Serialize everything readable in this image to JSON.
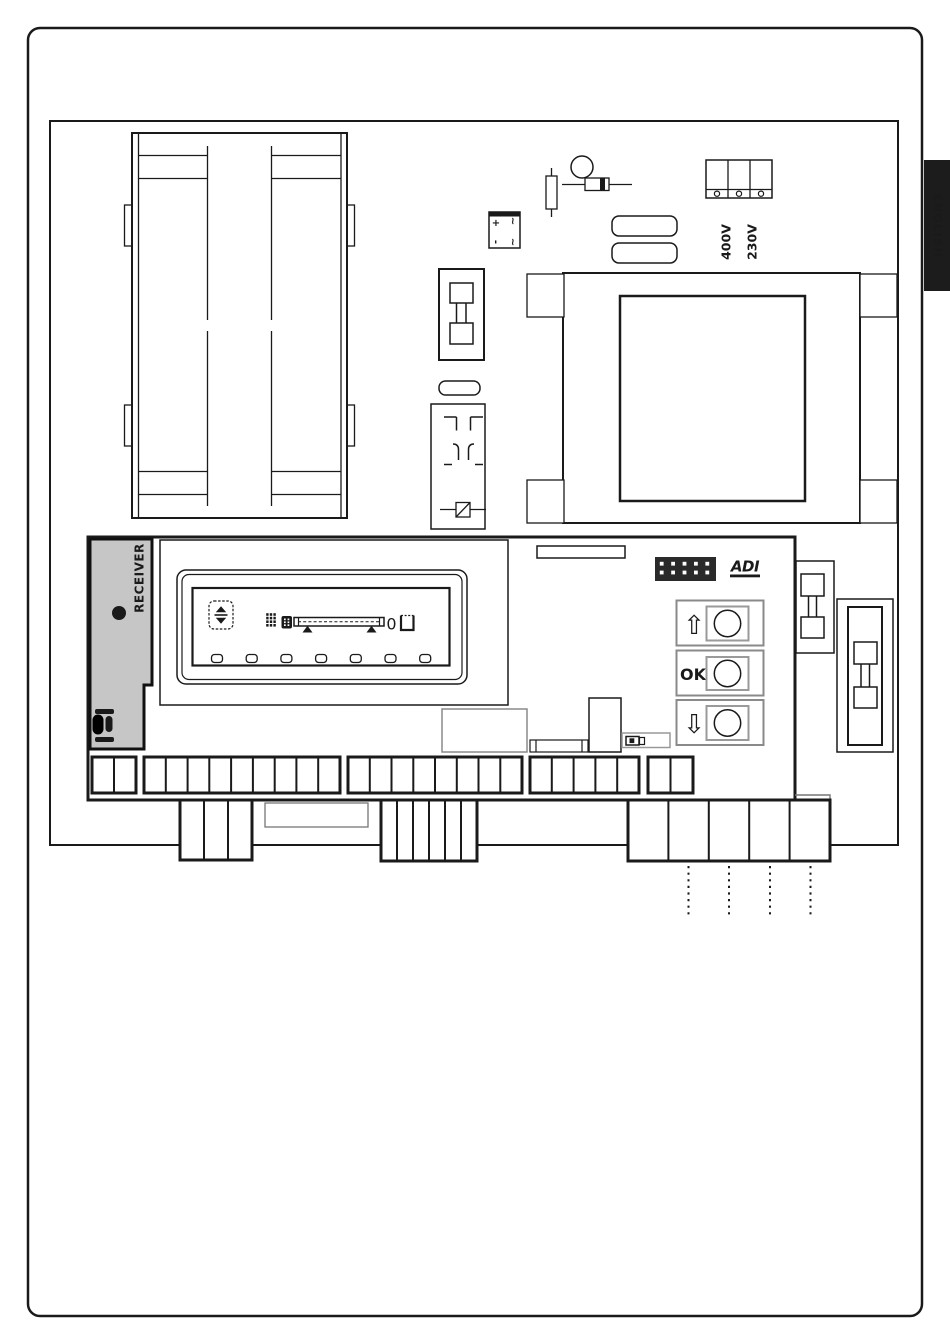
{
  "page": {
    "language_tab": "ENGLISH"
  },
  "colors": {
    "line": "#1a1a1a",
    "tab_bg": "#1c1c1c",
    "tab_text": "#ffffff",
    "receiver_fill": "#c6c6c6",
    "gray_border": "#8a8a8a"
  },
  "power_input": {
    "voltage_label_top": "400V",
    "voltage_label_bottom": "230V",
    "terminal_cells": 3
  },
  "rectifier": {
    "plus": "+",
    "ac_top": "~",
    "minus": "-",
    "ac_bottom": "~"
  },
  "control_board": {
    "receiver": {
      "label": "RECEIVER"
    },
    "logo_text": "ADI",
    "display": {
      "zero_indicator": "0",
      "led_count": 7
    },
    "buttons": {
      "up": "⇧",
      "ok": "OK",
      "down": "⇩"
    },
    "terminal_blocks": [
      {
        "name": "terminal-block-a",
        "cells": 2
      },
      {
        "name": "terminal-block-b",
        "cells": 9
      },
      {
        "name": "terminal-block-c",
        "cells": 8
      },
      {
        "name": "terminal-block-d",
        "cells": 5
      },
      {
        "name": "terminal-block-e",
        "cells": 2
      }
    ],
    "bottom_connectors": [
      {
        "name": "connector-1",
        "cells": 3
      },
      {
        "name": "connector-2",
        "cells": 6
      },
      {
        "name": "connector-3",
        "cells": 5
      }
    ]
  }
}
